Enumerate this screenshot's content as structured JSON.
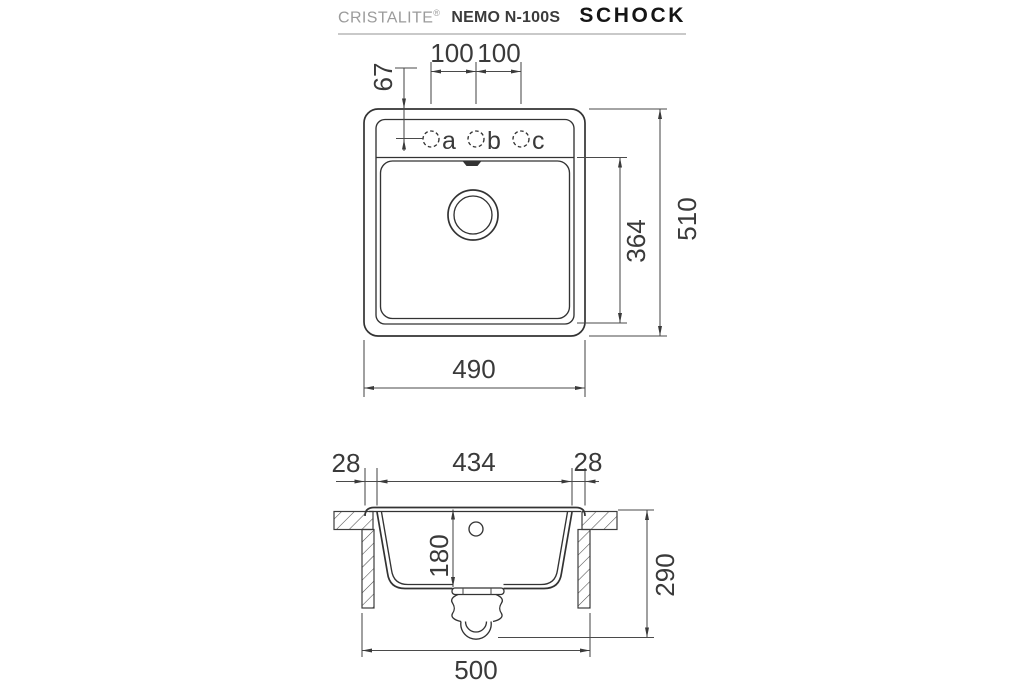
{
  "header": {
    "brand": "CRISTALITE",
    "registered": "®",
    "model": "NEMO N-100S",
    "logo": "SCHOCK"
  },
  "top_view": {
    "dim_hole_left": "100",
    "dim_hole_right": "100",
    "dim_hole_offset": "67",
    "dim_inner_length": "364",
    "dim_outer_length": "510",
    "dim_outer_width": "490",
    "holes": [
      "a",
      "b",
      "c"
    ]
  },
  "section_view": {
    "dim_rim_left": "28",
    "dim_bowl_width": "434",
    "dim_rim_right": "28",
    "dim_bowl_depth": "180",
    "dim_total_depth": "290",
    "dim_base_width": "500"
  },
  "colors": {
    "line": "#333333",
    "dimension_line": "#4a4a4a",
    "text": "#3a3a3a",
    "brand_gray": "#9b9b9b",
    "logo_black": "#151515"
  }
}
